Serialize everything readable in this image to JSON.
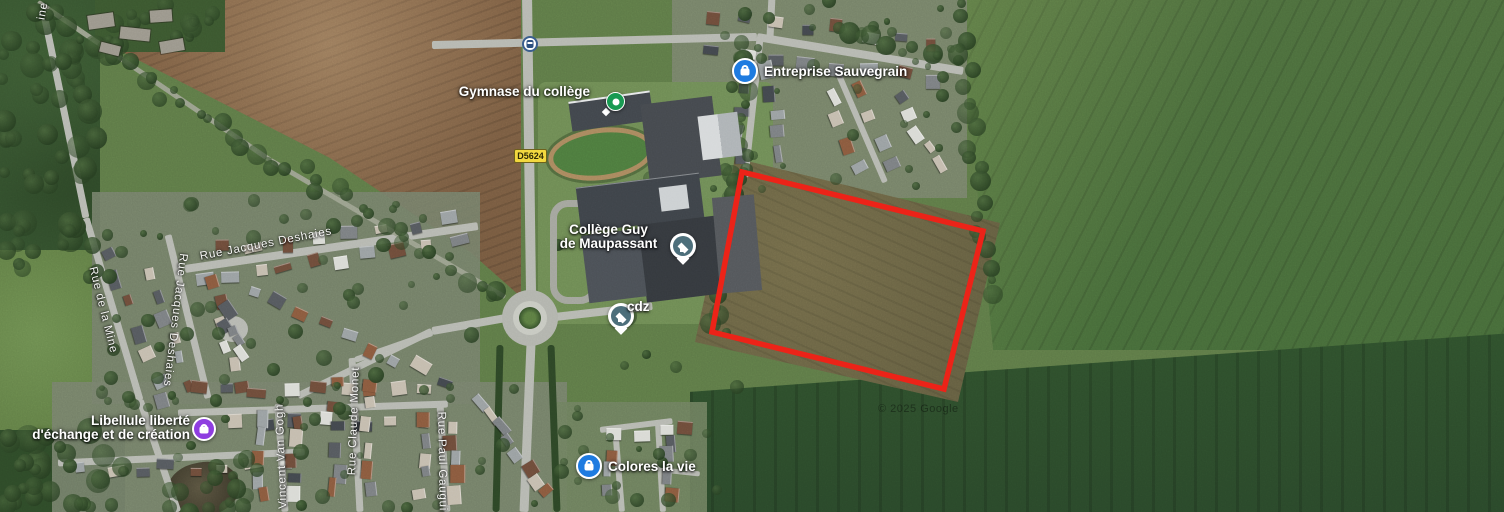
{
  "attribution": "© 2025 Google",
  "road_badge": "D5624",
  "parcel": {
    "points": "742,172 983,231 944,389 712,332",
    "color": "#ec2318"
  },
  "pois": {
    "gymnase": {
      "label": "Gymnase du collège"
    },
    "entreprise": {
      "label": "Entreprise Sauvegrain"
    },
    "college": {
      "line1": "Collège Guy",
      "line2": "de Maupassant"
    },
    "cdz": {
      "label": "cdz"
    },
    "colores": {
      "label": "Colores la vie"
    },
    "libellule": {
      "line1": "Libellule liberté",
      "line2": "d'échange et de création"
    }
  },
  "streets": {
    "jacques_deshaies_h": "Rue Jacques Deshaies",
    "jacques_deshaies_v": "Rue Jacques Deshaies",
    "de_la_mine": "Rue de la Mine",
    "claude_monet": "Rue Claude Monet",
    "vincent_van_gogh": "Rue Vincent Van Gogh",
    "paul_gauguin": "Rue Paul Gauguin",
    "partial_top_left": "ine"
  }
}
